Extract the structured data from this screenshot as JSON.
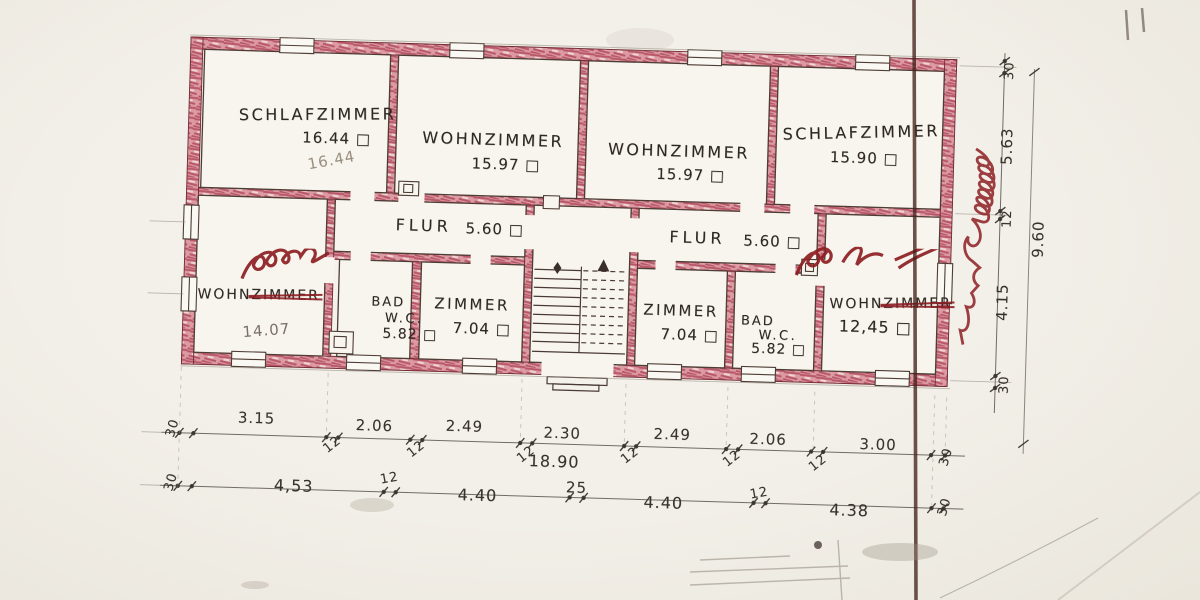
{
  "rooms": [
    {
      "id": "schlafzimmer-1",
      "name": "SCHLAFZIMMER",
      "area": "16.44 □",
      "pencil": "16.44"
    },
    {
      "id": "wohnzimmer-1",
      "name": "WOHNZIMMER",
      "area": "15.97 □"
    },
    {
      "id": "wohnzimmer-2",
      "name": "WOHNZIMMER",
      "area": "15.97 □"
    },
    {
      "id": "schlafzimmer-2",
      "name": "SCHLAFZIMMER",
      "area": "15.90 □"
    },
    {
      "id": "flur-1",
      "name": "FLUR",
      "area": "5.60 □"
    },
    {
      "id": "flur-2",
      "name": "FLUR",
      "area": "5.60 □"
    },
    {
      "id": "wohnzimmer-3",
      "prefix": "WOHN",
      "struck": "ZIMMER",
      "area": "14.07"
    },
    {
      "id": "bad-wc-1",
      "line1": "BAD",
      "line2": "W.C.",
      "area": "5.82 □"
    },
    {
      "id": "zimmer-1",
      "name": "ZIMMER",
      "area": "7.04 □"
    },
    {
      "id": "zimmer-2",
      "name": "ZIMMER",
      "area": "7.04 □"
    },
    {
      "id": "bad-wc-2",
      "line1": "BAD",
      "line2": "W.C.",
      "area": "5.82 □"
    },
    {
      "id": "wohnzimmer-4",
      "prefix": "WOHN",
      "struck": "ZIMMER",
      "area": "12,45 □"
    }
  ],
  "dimensions": {
    "row1": [
      "30",
      "3.15",
      "12",
      "2.06",
      "12",
      "2.49",
      "12",
      "2.30",
      "12",
      "2.49",
      "12",
      "2.06",
      "12",
      "3.00",
      "30"
    ],
    "row1_total": "18.90",
    "row2": [
      "30",
      "4,53",
      "12",
      "4.40",
      "25",
      "4.40",
      "12",
      "4.38",
      "30"
    ],
    "right_column": [
      "30",
      "5.63",
      "12",
      "4.15",
      "30"
    ],
    "right_total": "9.60"
  },
  "colors": {
    "wall_pink": "#c25a6b",
    "red_ink": "#8c1d22",
    "graphite": "#2f2822",
    "paper": "#f2efe8"
  }
}
